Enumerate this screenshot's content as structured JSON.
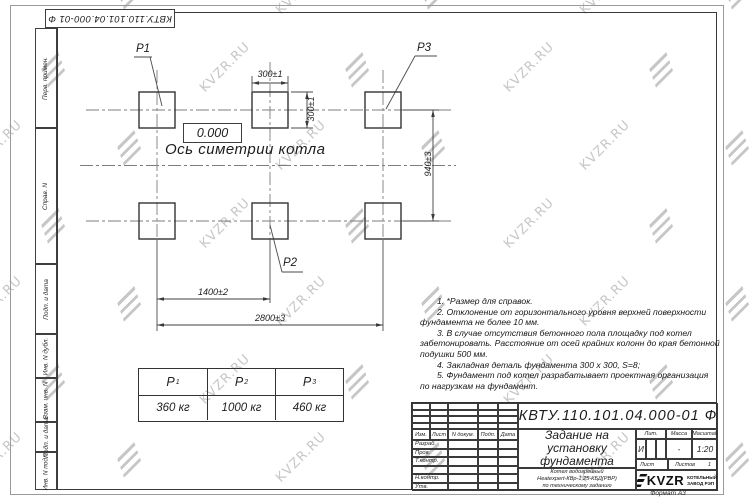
{
  "watermark": {
    "text": "KVZR.RU"
  },
  "corner_stamp": {
    "doc_number": "КВТУ.110.101.04.000-01 Ф"
  },
  "left_strip": {
    "labels": [
      "Перв. примен.",
      "Справ. N",
      "Подп. и дата",
      "Инв. N дубл.",
      "Взам. инв. N",
      "Подп. и дата",
      "Инв. N подл."
    ]
  },
  "drawing": {
    "elevation": "0.000",
    "axis_label": "Ось симетрии котла",
    "points": {
      "p1": "Р1",
      "p2": "Р2",
      "p3": "Р3"
    },
    "dims": {
      "block_width": "300±1",
      "block_height": "300±1",
      "row_spacing": "940±3",
      "col_spacing": "1400±2",
      "total_span": "2800±3"
    }
  },
  "notes": {
    "lines": [
      "1. *Размер для справок.",
      "2. Отклонение от горизонтального уровня верхней поверхности",
      "фундамента не более 10 мм.",
      "3. В случае отсутствия бетонного пола площадку под котел",
      "забетонировать. Расстояние от осей крайних колонн до края бетонной",
      "подушки 500 мм.",
      "4. Закладная деталь фундамента  300 x 300, S=8;",
      "5. Фундамент под котел разрабатывает проектная организация",
      "по нагрузкам на фундамент."
    ]
  },
  "loads_table": {
    "columns": [
      {
        "sym": "Р",
        "sub": "1",
        "value": "360 кг"
      },
      {
        "sym": "Р",
        "sub": "2",
        "value": "1000 кг"
      },
      {
        "sym": "Р",
        "sub": "3",
        "value": "460 кг"
      }
    ]
  },
  "title_block": {
    "doc_number": "КВТУ.110.101.04.000-01 Ф",
    "title_lines": [
      "Задание на",
      "установку",
      "фундамента"
    ],
    "product_lines": [
      "Котел водогрейный",
      "Heatexpert-КВр-1,25-КБД(РВР)",
      "по техническому заданию"
    ],
    "header": {
      "izm": "Изм.",
      "list": "Лист",
      "ndok": "N докум.",
      "podp": "Подп.",
      "data": "Дата"
    },
    "rows": [
      "Разраб.",
      "Пров.",
      "Т.контр.",
      "",
      "Н.контр.",
      "Утв."
    ],
    "right": {
      "lit_label": "Лит.",
      "mass_label": "Масса",
      "scale_label": "Масштаб",
      "lit": "И",
      "mass": "-",
      "scale": "1:20",
      "sheet_label": "Лист",
      "sheets_label": "Листов",
      "sheets": "1"
    },
    "logo": {
      "text": "KVZR",
      "company_line1": "КОТЕЛЬНЫЙ",
      "company_line2": "ЗАВОД РЭП"
    },
    "format": "Формат А3"
  }
}
